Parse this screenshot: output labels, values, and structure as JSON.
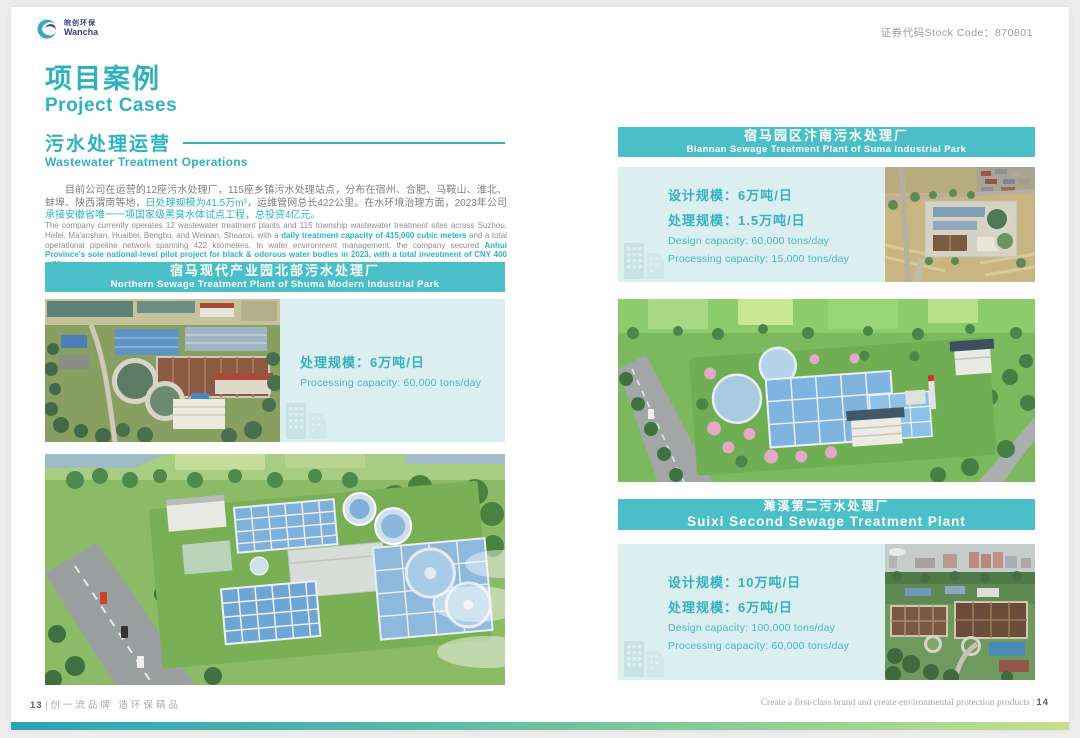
{
  "header": {
    "logo": {
      "cn": "皖创环保",
      "en": "Wancha"
    },
    "stock_code": "证券代码Stock Code：870801"
  },
  "title": {
    "cn": "项目案例",
    "en": "Project Cases"
  },
  "section": {
    "cn": "污水处理运营",
    "en": "Wastewater Treatment Operations"
  },
  "intro_cn": {
    "p1": "目前公司在运营的12座污水处理厂，115座乡镇污水处理站点，分布在宿州、合肥、马鞍山、淮北、蚌埠、陕西渭南等地，",
    "h1": "日处理规模为41.5万m³",
    "p2": "，运维管网总长422公里。在水环境治理方面，2023年公司",
    "h2": "承接安徽省唯一一项国家级黑臭水体试点工程，总投资4亿元。"
  },
  "intro_en": {
    "p1": "The company currently operates 12 wastewater treatment plants and 115 township wastewater treatment sites across Suzhou, Hefei, Ma'anshan, Huaibei, Bengbu, and Weinan, Shaanxi, with a ",
    "h1": "daily treatment capacity of 415,000 cubic meters",
    "p2": " and a total operational pipeline network spanning 422 kilometers. In water environment management, the company secured ",
    "h2": "Anhui Province's sole national-level pilot project for black & odorous water bodies in 2023, with a total investment of CNY 400 million yuan."
  },
  "projects": [
    {
      "name_cn": "宿马现代产业园北部污水处理厂",
      "name_en": "Northern Sewage Treatment Plant of Shuma Modern Industrial Park",
      "processing_cn": "处理规模：6万吨/日",
      "processing_en": "Processing capacity: 60,000 tons/day"
    },
    {
      "name_cn": "宿马园区汴南污水处理厂",
      "name_en": "Biannan Sewage Treatment Plant of Suma Industrial Park",
      "design_cn": "设计规模：6万吨/日",
      "processing_cn": "处理规模：1.5万吨/日",
      "design_en": "Design capacity: 60,000 tons/day",
      "processing_en": "Processing capacity: 15,000 tons/day"
    },
    {
      "name_cn": "濉溪第二污水处理厂",
      "name_en": "Suixi Second Sewage Treatment Plant",
      "design_cn": "设计规模：10万吨/日",
      "processing_cn": "处理规模：6万吨/日",
      "design_en": "Design capacity: 100,000 tons/day",
      "processing_en": "Processing capacity: 60,000 tons/day"
    }
  ],
  "footer": {
    "left_page": "13",
    "divider": "|",
    "slogan_cn": "创一流品牌 造环保精品",
    "slogan_en": "Create a first-class brand and create environmental protection products",
    "right_page": "14"
  },
  "colors": {
    "accent": "#2fb2c0",
    "banner": "#4bbfc7",
    "info_bg": "#dbeef0"
  }
}
